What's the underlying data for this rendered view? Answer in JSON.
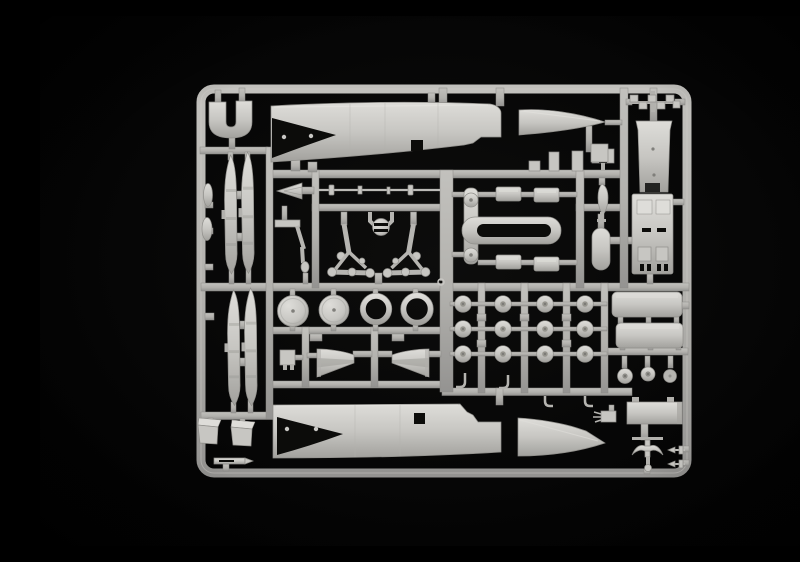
{
  "scene": {
    "alt": "Photograph of a light grey injection-moulded plastic model aircraft sprue (parts frame) on a black background",
    "colors": {
      "background": "#060606",
      "plastic": "#c7c6c2",
      "plastic_highlight": "#deddd9",
      "plastic_shadow": "#8f8e8a",
      "runner": "#b2b1ad",
      "recess": "#0c0c0a"
    }
  },
  "sprue": {
    "parts": [
      {
        "name": "fuselage-half-upper",
        "qty": 1
      },
      {
        "name": "fuselage-half-lower",
        "qty": 1
      },
      {
        "name": "nose-cone-upper",
        "qty": 1
      },
      {
        "name": "nose-cone-lower",
        "qty": 1
      },
      {
        "name": "cockpit-u-frame",
        "qty": 1
      },
      {
        "name": "leading-edge-strip",
        "qty": 4
      },
      {
        "name": "drop-tank-half",
        "qty": 2
      },
      {
        "name": "main-wheel-disc",
        "qty": 2
      },
      {
        "name": "tire-ring",
        "qty": 2
      },
      {
        "name": "small-wheel",
        "qty": 12
      },
      {
        "name": "nose-wheel",
        "qty": 3
      },
      {
        "name": "landing-gear-strut",
        "qty": 2
      },
      {
        "name": "gear-bracket",
        "qty": 1
      },
      {
        "name": "hub-pulley",
        "qty": 1
      },
      {
        "name": "pitot-probe",
        "qty": 1
      },
      {
        "name": "nose-dart",
        "qty": 1
      },
      {
        "name": "t-frame-handle",
        "qty": 1
      },
      {
        "name": "exhaust-cylinder",
        "qty": 4
      },
      {
        "name": "intake-scoop",
        "qty": 2
      },
      {
        "name": "wheel-well-box",
        "qty": 2
      },
      {
        "name": "ejection-seat-back",
        "qty": 1
      },
      {
        "name": "ejection-seat-base",
        "qty": 1
      },
      {
        "name": "boarding-ladder",
        "qty": 1
      },
      {
        "name": "equipment-panel",
        "qty": 1
      },
      {
        "name": "tail-anchor",
        "qty": 1
      },
      {
        "name": "missile-dart",
        "qty": 2
      },
      {
        "name": "teardrop-fairing",
        "qty": 3
      },
      {
        "name": "fuel-capsule",
        "qty": 1
      },
      {
        "name": "antenna-strip",
        "qty": 1
      },
      {
        "name": "small-fitting",
        "qty": 10
      }
    ]
  }
}
